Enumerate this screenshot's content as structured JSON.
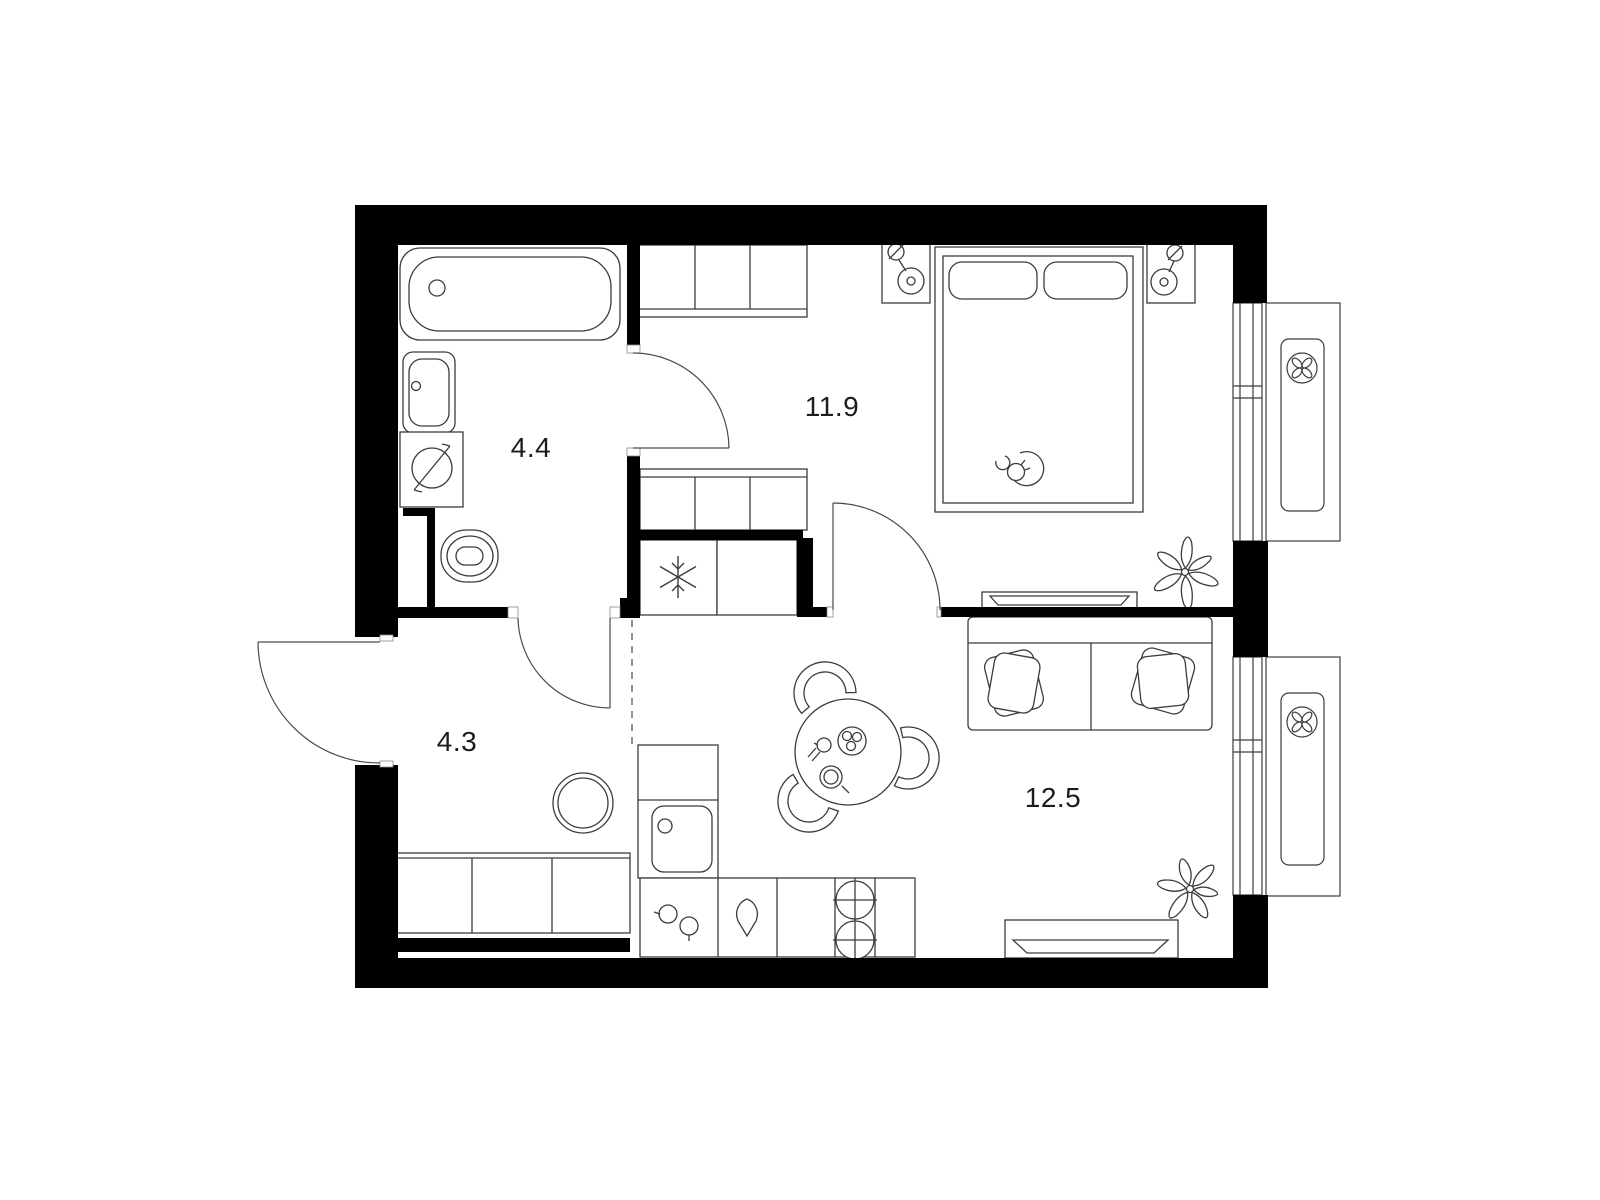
{
  "plan": {
    "rooms": [
      {
        "id": "bathroom",
        "label": "4.4"
      },
      {
        "id": "bedroom",
        "label": "11.9"
      },
      {
        "id": "hallway",
        "label": "4.3"
      },
      {
        "id": "living_kitchen",
        "label": "12.5"
      }
    ],
    "icons": {
      "ac_fan": "fan-icon",
      "freezer": "snowflake-icon",
      "electric_panel": "lightning-icon"
    },
    "colors": {
      "wall": "#000000",
      "line": "#3c3c3c",
      "background": "#ffffff"
    }
  }
}
